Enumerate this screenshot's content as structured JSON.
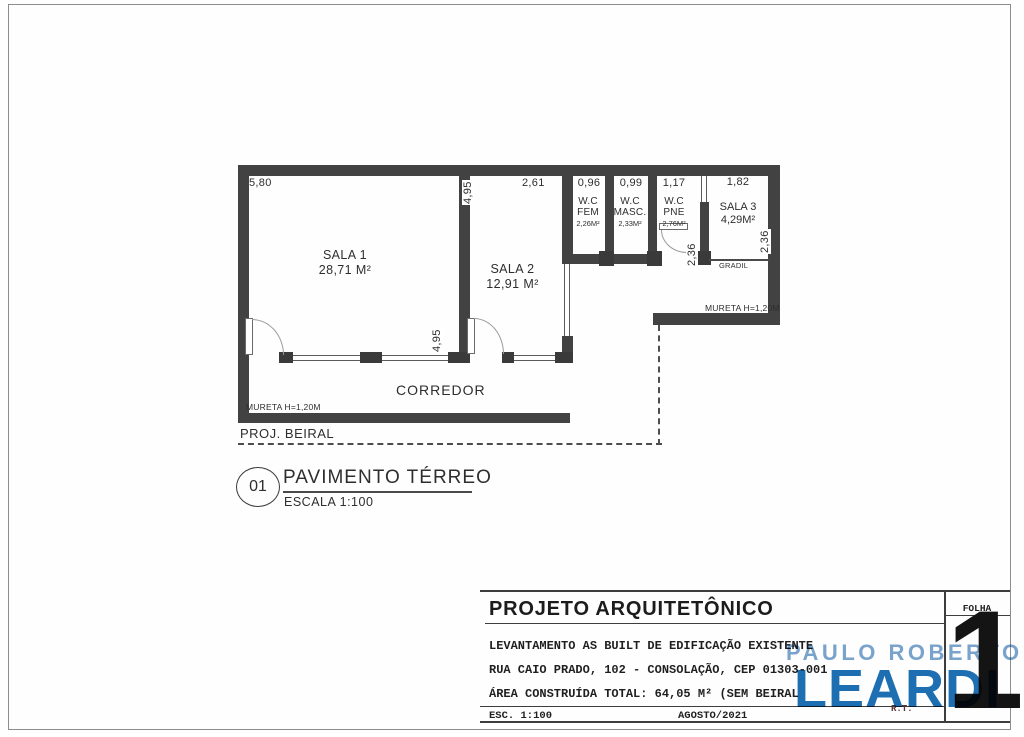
{
  "plan": {
    "dims": {
      "sala1_width": "5,80",
      "height_top": "4,95",
      "sala2_width": "2,61",
      "wc_fem_width": "0,96",
      "wc_masc_width": "0,99",
      "wc_pne_width": "1,17",
      "sala3_width": "1,82",
      "height_bottom": "4,95",
      "pne_depth": "2,36",
      "sala3_depth": "2,36"
    },
    "rooms": {
      "sala1": {
        "name": "SALA 1",
        "area": "28,71 M²"
      },
      "sala2": {
        "name": "SALA 2",
        "area": "12,91 M²"
      },
      "wc_fem": {
        "line1": "W.C",
        "line2": "FEM",
        "area": "2,26M²"
      },
      "wc_masc": {
        "line1": "W.C",
        "line2": "MASC.",
        "area": "2,33M²"
      },
      "wc_pne": {
        "line1": "W.C",
        "line2": "PNE",
        "area": "2,76M²"
      },
      "sala3": {
        "name": "SALA 3",
        "area": "4,29M²"
      },
      "corredor": "CORREDOR"
    },
    "labels": {
      "gradil": "GRADIL",
      "mureta_right": "MURETA H=1,20M",
      "mureta_left": "MURETA H=1,20M",
      "proj_beiral": "PROJ. BEIRAL"
    }
  },
  "plan_title": {
    "number": "01",
    "title": "PAVIMENTO TÉRREO",
    "scale": "ESCALA 1:100"
  },
  "title_block": {
    "title": "PROJETO ARQUITETÔNICO",
    "line1": "LEVANTAMENTO AS BUILT DE EDIFICAÇÃO EXISTENTE",
    "line2": "RUA CAIO PRADO, 102 - CONSOLAÇÃO, CEP 01303-001",
    "line3": "ÁREA CONSTRUÍDA TOTAL: 64,05 M² (SEM BEIRAL",
    "scale": "ESC. 1:100",
    "date": "AGOSTO/2021",
    "rt": "R.T.",
    "folha_label": "FOLHA",
    "folha_number": "1"
  },
  "watermark": {
    "top": "PAULO ROBERTO",
    "bottom": "LEARDI"
  },
  "colors": {
    "wall": "#424242",
    "text": "#2e2e2e",
    "watermark_light_blue": "#7aa4cc",
    "watermark_blue": "#1d6fb3",
    "folha_number_black": "#141414"
  }
}
